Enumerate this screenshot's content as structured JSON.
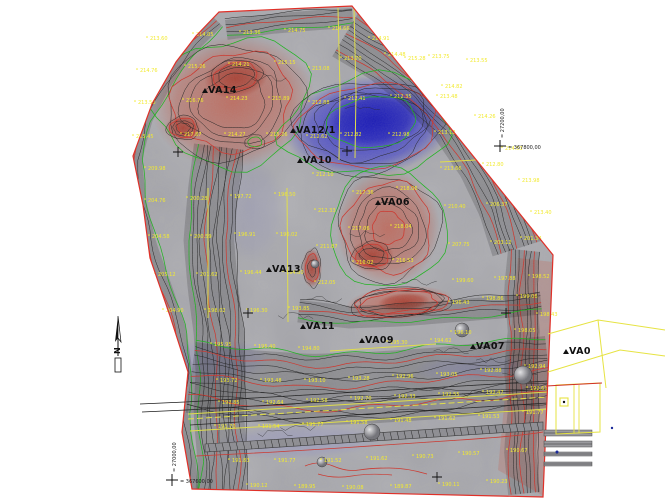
{
  "map": {
    "stations": [
      {
        "label": "VA14",
        "x": 208,
        "y": 93
      },
      {
        "label": "VA12/1",
        "x": 296,
        "y": 133
      },
      {
        "label": "VA10",
        "x": 303,
        "y": 163
      },
      {
        "label": "VA06",
        "x": 381,
        "y": 205
      },
      {
        "label": "VA13",
        "x": 272,
        "y": 272
      },
      {
        "label": "VA11",
        "x": 306,
        "y": 329
      },
      {
        "label": "VA09",
        "x": 365,
        "y": 343
      },
      {
        "label": "VA07",
        "x": 476,
        "y": 349
      },
      {
        "label": "VA0",
        "x": 569,
        "y": 354
      }
    ],
    "north_arrow": {
      "label": "N",
      "x": 118,
      "y": 316
    },
    "coordinate_marks": [
      {
        "x": 500,
        "y": 146,
        "vertical": "= 27200,00",
        "horizontal": "= 367800,00"
      },
      {
        "x": 172,
        "y": 480,
        "vertical": "= 27000,00",
        "horizontal": "= 367600,00"
      }
    ],
    "grid_crosses": [
      [
        178,
        152
      ],
      [
        347,
        151
      ],
      [
        248,
        313
      ],
      [
        506,
        313
      ],
      [
        437,
        477
      ]
    ],
    "spot_heights": [
      [
        150,
        40,
        "213.60"
      ],
      [
        196,
        36,
        "214.05"
      ],
      [
        243,
        34,
        "213.36"
      ],
      [
        288,
        32,
        "214.75"
      ],
      [
        332,
        30,
        "214.66"
      ],
      [
        372,
        40,
        "214.91"
      ],
      [
        408,
        60,
        "215.28"
      ],
      [
        445,
        88,
        "214.82"
      ],
      [
        478,
        118,
        "214.26"
      ],
      [
        505,
        150,
        "214.53"
      ],
      [
        522,
        182,
        "213.98"
      ],
      [
        534,
        214,
        "213.40"
      ],
      [
        140,
        72,
        "214.76"
      ],
      [
        188,
        68,
        "215.26"
      ],
      [
        232,
        66,
        "214.21"
      ],
      [
        278,
        64,
        "215.15"
      ],
      [
        138,
        104,
        "213.56"
      ],
      [
        186,
        102,
        "216.76"
      ],
      [
        230,
        100,
        "214.23"
      ],
      [
        272,
        100,
        "215.89"
      ],
      [
        136,
        138,
        "215.45"
      ],
      [
        184,
        136,
        "217.87"
      ],
      [
        228,
        136,
        "214.27"
      ],
      [
        270,
        136,
        "215.26"
      ],
      [
        312,
        70,
        "213.08"
      ],
      [
        312,
        104,
        "212.88"
      ],
      [
        310,
        138,
        "212.62"
      ],
      [
        344,
        60,
        "213.70"
      ],
      [
        388,
        56,
        "214.48"
      ],
      [
        432,
        58,
        "213.75"
      ],
      [
        470,
        62,
        "213.55"
      ],
      [
        348,
        100,
        "212.41"
      ],
      [
        394,
        98,
        "212.35"
      ],
      [
        440,
        98,
        "213.48"
      ],
      [
        344,
        136,
        "212.82"
      ],
      [
        392,
        136,
        "212.98"
      ],
      [
        438,
        134,
        "213.12"
      ],
      [
        148,
        170,
        "209.98"
      ],
      [
        148,
        202,
        "204.76"
      ],
      [
        190,
        200,
        "200.28"
      ],
      [
        234,
        198,
        "197.72"
      ],
      [
        278,
        196,
        "196.50"
      ],
      [
        152,
        238,
        "204.58"
      ],
      [
        194,
        238,
        "200.59"
      ],
      [
        238,
        236,
        "196.91"
      ],
      [
        280,
        236,
        "196.02"
      ],
      [
        158,
        276,
        "205.12"
      ],
      [
        200,
        276,
        "201.62"
      ],
      [
        244,
        274,
        "196.44"
      ],
      [
        286,
        274,
        "194.80"
      ],
      [
        166,
        312,
        "204.90"
      ],
      [
        208,
        312,
        "198.02"
      ],
      [
        250,
        312,
        "196.30"
      ],
      [
        292,
        310,
        "193.85"
      ],
      [
        316,
        176,
        "212.10"
      ],
      [
        318,
        212,
        "212.33"
      ],
      [
        320,
        248,
        "211.87"
      ],
      [
        318,
        284,
        "212.05"
      ],
      [
        356,
        194,
        "217.36"
      ],
      [
        400,
        190,
        "218.06"
      ],
      [
        352,
        230,
        "217.06"
      ],
      [
        394,
        228,
        "218.04"
      ],
      [
        356,
        264,
        "216.02"
      ],
      [
        396,
        262,
        "216.53"
      ],
      [
        444,
        170,
        "213.66"
      ],
      [
        486,
        166,
        "212.80"
      ],
      [
        448,
        208,
        "210.40"
      ],
      [
        490,
        206,
        "206.37"
      ],
      [
        524,
        240,
        "201.34"
      ],
      [
        452,
        246,
        "207.75"
      ],
      [
        494,
        244,
        "203.12"
      ],
      [
        456,
        282,
        "199.60"
      ],
      [
        498,
        280,
        "197.88"
      ],
      [
        532,
        278,
        "198.52"
      ],
      [
        452,
        304,
        "196.43"
      ],
      [
        486,
        300,
        "198.86"
      ],
      [
        520,
        298,
        "199.06"
      ],
      [
        454,
        334,
        "196.10"
      ],
      [
        518,
        332,
        "198.05"
      ],
      [
        540,
        316,
        "198.43"
      ],
      [
        214,
        346,
        "195.95"
      ],
      [
        258,
        348,
        "195.40"
      ],
      [
        302,
        350,
        "194.80"
      ],
      [
        390,
        344,
        "195.30"
      ],
      [
        434,
        342,
        "194.62"
      ],
      [
        220,
        382,
        "193.72"
      ],
      [
        264,
        382,
        "193.48"
      ],
      [
        308,
        382,
        "193.10"
      ],
      [
        352,
        380,
        "193.28"
      ],
      [
        396,
        378,
        "192.96"
      ],
      [
        440,
        376,
        "193.05"
      ],
      [
        484,
        372,
        "192.88"
      ],
      [
        528,
        368,
        "192.94"
      ],
      [
        222,
        404,
        "192.85"
      ],
      [
        266,
        404,
        "192.64"
      ],
      [
        310,
        402,
        "192.58"
      ],
      [
        354,
        400,
        "192.70"
      ],
      [
        398,
        398,
        "192.33"
      ],
      [
        442,
        396,
        "192.55"
      ],
      [
        486,
        394,
        "192.47"
      ],
      [
        530,
        390,
        "192.61"
      ],
      [
        218,
        428,
        "191.70"
      ],
      [
        262,
        428,
        "191.54"
      ],
      [
        306,
        426,
        "191.77"
      ],
      [
        350,
        424,
        "191.58"
      ],
      [
        394,
        422,
        "191.48"
      ],
      [
        438,
        420,
        "191.62"
      ],
      [
        482,
        418,
        "191.53"
      ],
      [
        526,
        414,
        "191.77"
      ],
      [
        232,
        462,
        "191.83"
      ],
      [
        278,
        462,
        "191.77"
      ],
      [
        324,
        462,
        "191.52"
      ],
      [
        370,
        460,
        "191.62"
      ],
      [
        416,
        458,
        "190.73"
      ],
      [
        462,
        455,
        "190.57"
      ],
      [
        510,
        452,
        "190.67"
      ],
      [
        250,
        487,
        "190.12"
      ],
      [
        298,
        488,
        "189.95"
      ],
      [
        346,
        489,
        "190.08"
      ],
      [
        394,
        488,
        "189.87"
      ],
      [
        442,
        486,
        "190.11"
      ],
      [
        490,
        483,
        "190.23"
      ]
    ],
    "colors": {
      "base_gray": "#b4b4b8",
      "contour": "#1b1b1b",
      "index_contour": "#d03026",
      "vegetation_green": "#17b517",
      "parcel_yellow": "#e6e342",
      "spot_label": "#f2ea30",
      "boundary_red": "#e03028",
      "station_label": "#101010",
      "pit_blue": "#2b2bd0",
      "pit_blue_deep": "#1717b6",
      "hill_red": "#c4604f",
      "hill_red_deep": "#a83c2e",
      "lavender": "#8f8fc8",
      "road_gray": "#6a6a6e"
    }
  }
}
